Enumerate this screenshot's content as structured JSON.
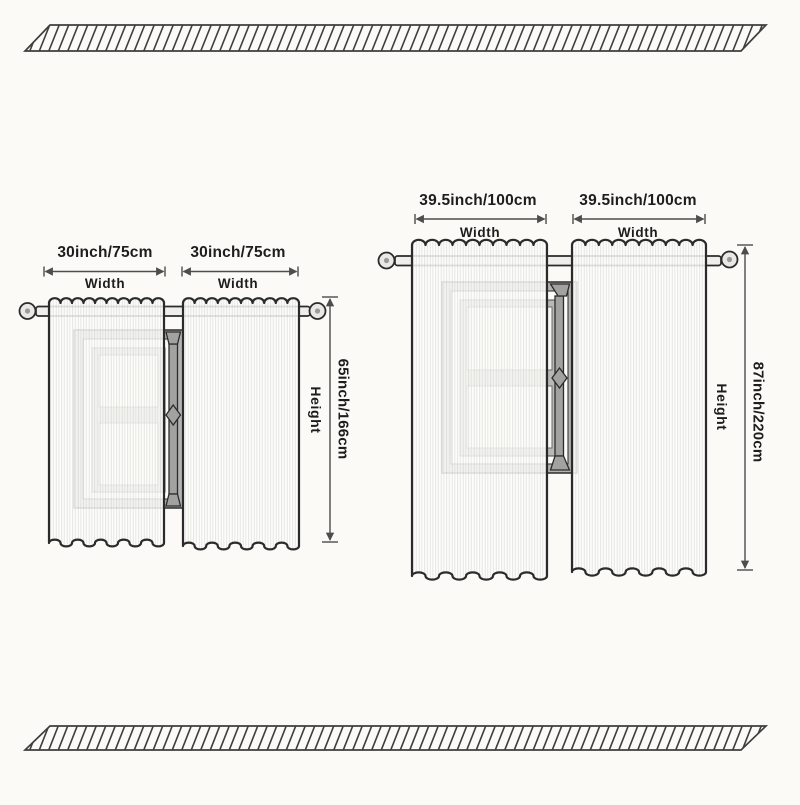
{
  "image_type": "curtain-size-dimension-diagram",
  "colors": {
    "background": "#fbfaf6",
    "outline": "#2b2b2b",
    "dimension": "#4d4d4d",
    "text": "#1d1d1d",
    "curtain": "#fdfdfb",
    "rod": "#efeeea",
    "finial": "#e9e8e4",
    "window_frame": "#b3b3b1",
    "window_inner": "#fbfbf9",
    "window_pane": "#f6f6f4",
    "window_post": "#a2a2a0",
    "hatch": "#3e3e3e"
  },
  "diagrams": [
    {
      "name": "small-curtain",
      "panels": [
        {
          "width_label": "30inch/75cm",
          "width_caption": "Width"
        },
        {
          "width_label": "30inch/75cm",
          "width_caption": "Width"
        }
      ],
      "height_label": "65inch/166cm",
      "height_caption": "Height"
    },
    {
      "name": "large-curtain",
      "panels": [
        {
          "width_label": "39.5inch/100cm",
          "width_caption": "Width"
        },
        {
          "width_label": "39.5inch/100cm",
          "width_caption": "Width"
        }
      ],
      "height_label": "87inch/220cm",
      "height_caption": "Height"
    }
  ]
}
